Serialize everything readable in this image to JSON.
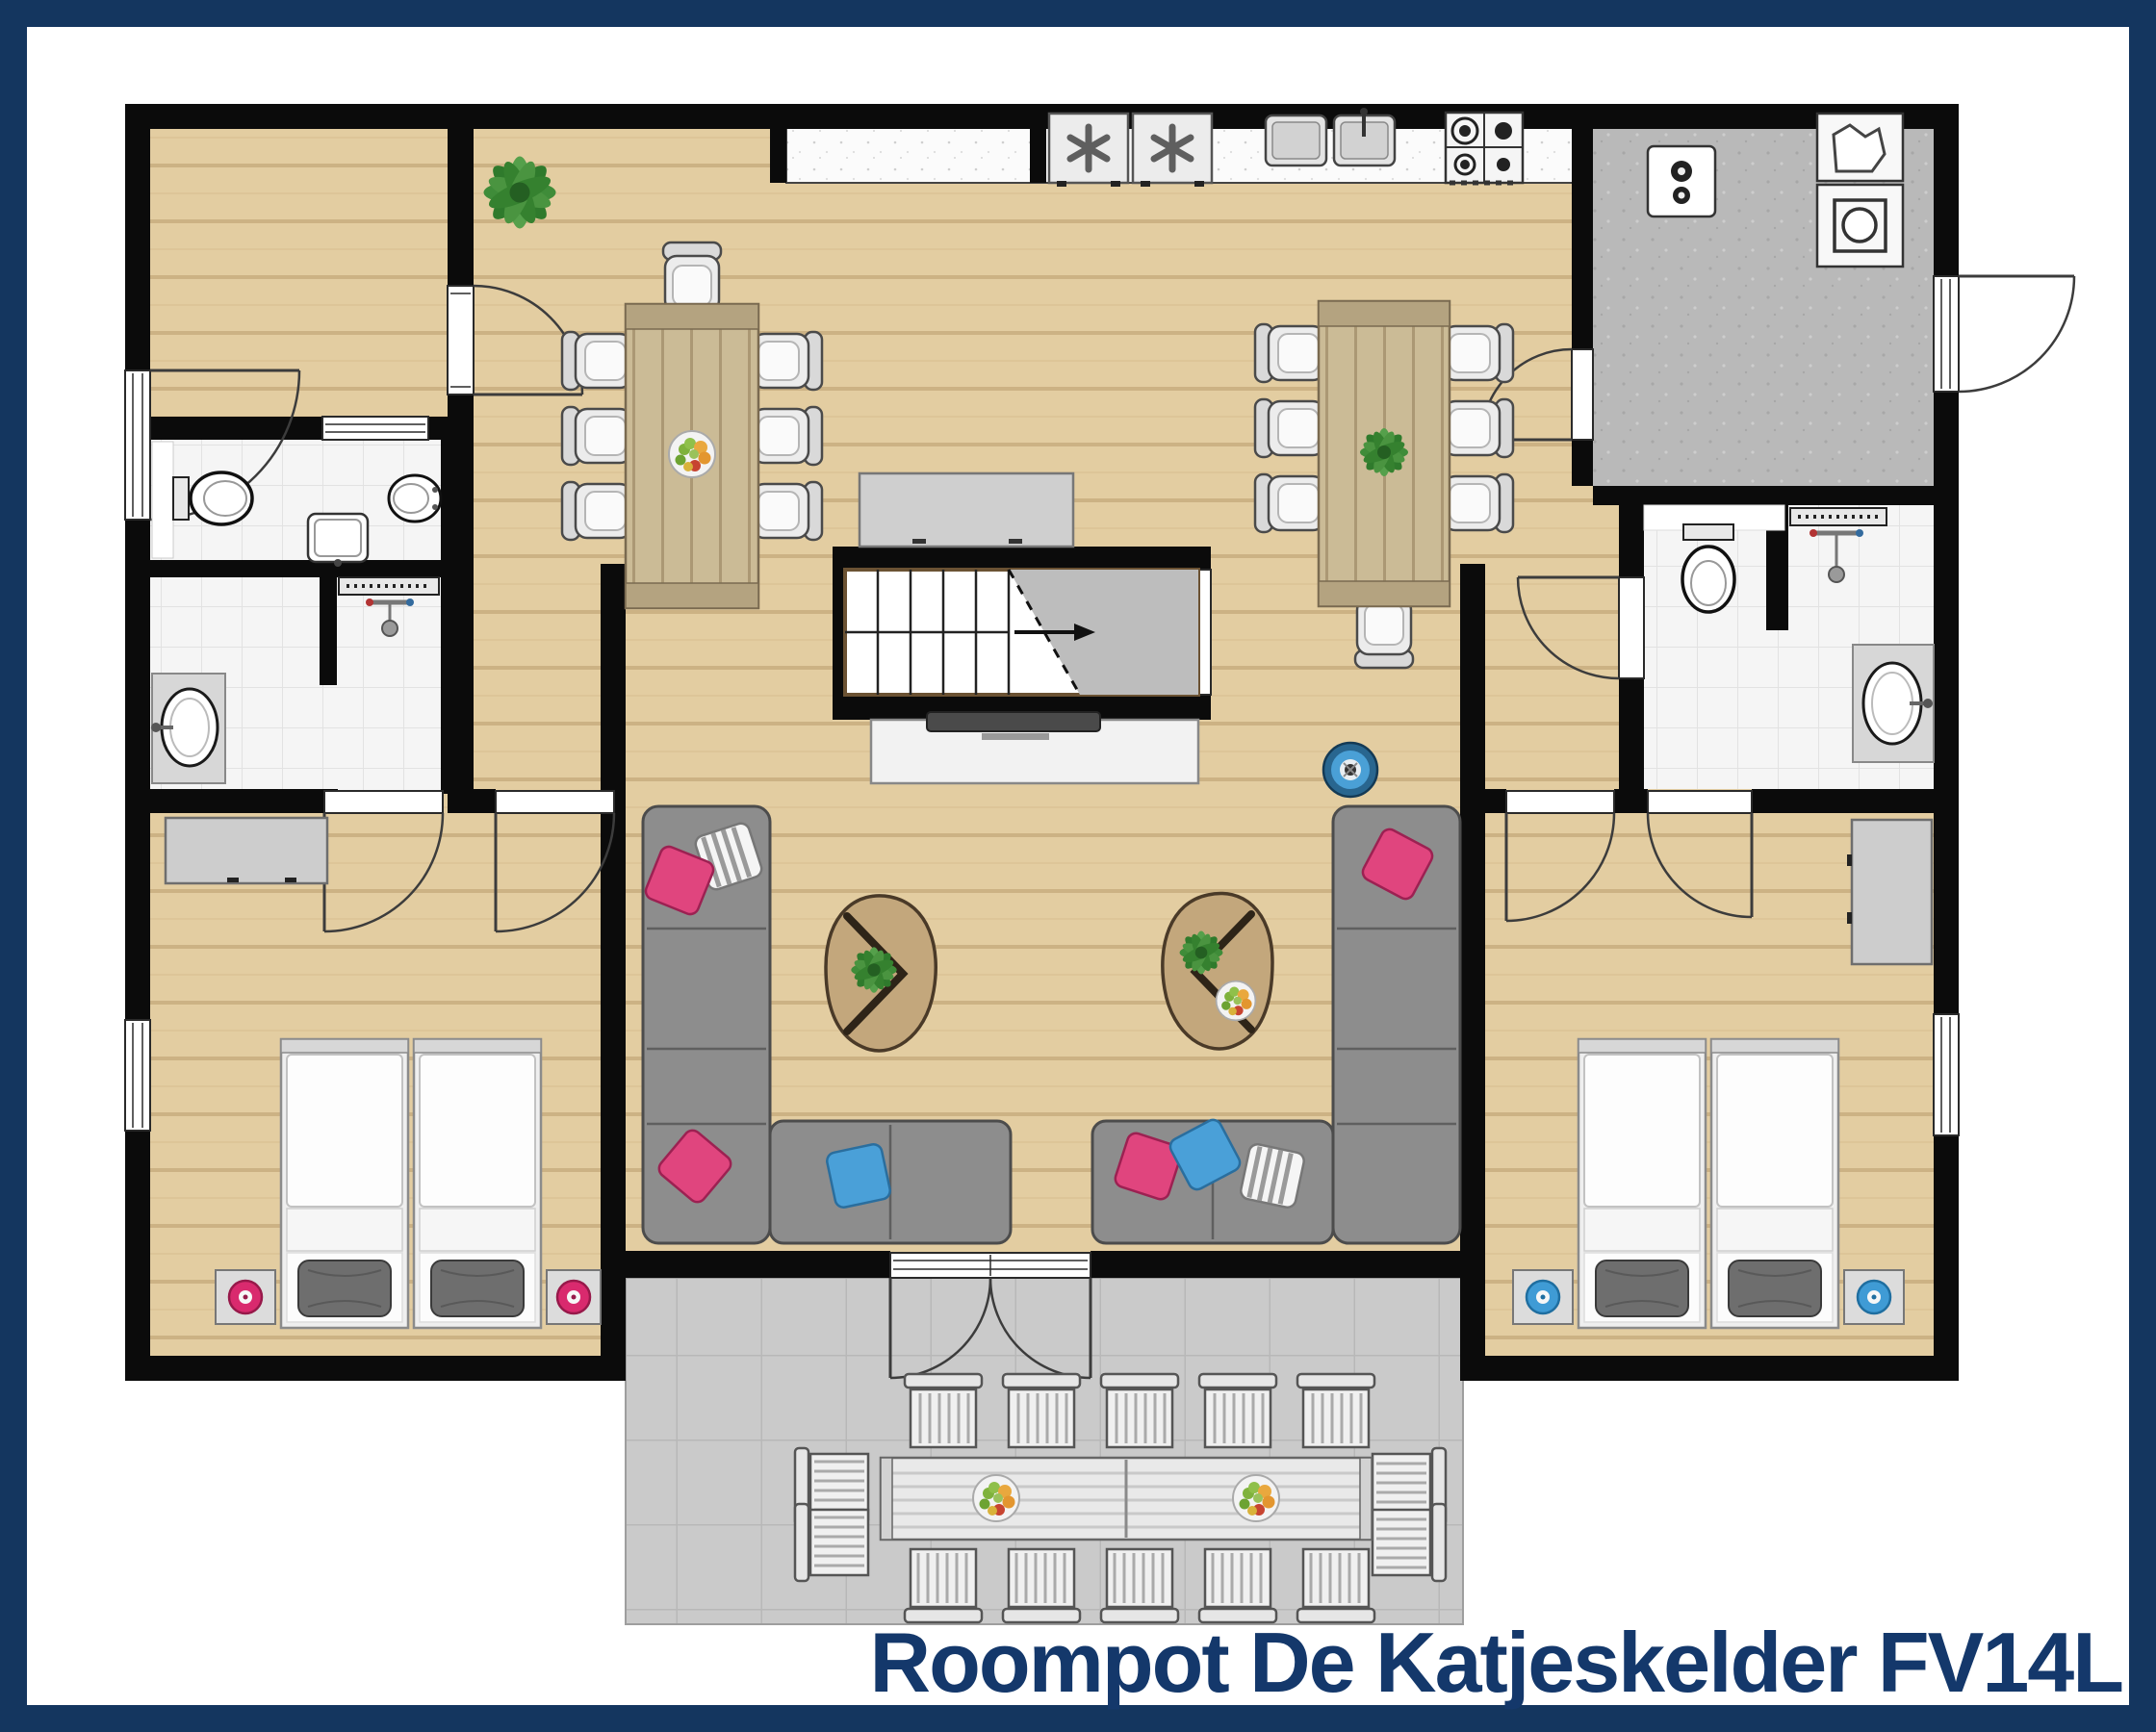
{
  "title": {
    "text": "Roompot De Katjeskelder FV14L"
  },
  "colors": {
    "frame": "#14365f",
    "title": "#14386b",
    "wall": "#0b0b0b",
    "wood_floor": "#e3cda1",
    "wood_plank_line": "#c4a97b",
    "table_wood": "#cbbb96",
    "tile_floor": "#f5f5f5",
    "concrete_floor": "#b9b9b9",
    "terrace_floor": "#cacaca",
    "counter_top": "#fbfbfb",
    "sofa_gray": "#8d8d8d",
    "accent_pink": "#d92a6e",
    "accent_blue": "#3f9bd5",
    "plant_green": "#3f8c39"
  },
  "rooms": [
    {
      "id": "entrance-hall",
      "label": "entrance hall",
      "furniture": [
        "entrance-door",
        "door-to-living-room",
        "plant"
      ]
    },
    {
      "id": "toilet-room-left",
      "label": "toilet room",
      "furniture": [
        "toilet",
        "bidet",
        "washbasin"
      ]
    },
    {
      "id": "shower-room-left",
      "label": "shower room",
      "furniture": [
        "shower-drain-channel",
        "shower-mixer",
        "washbasin-on-counter",
        "partition-wall"
      ]
    },
    {
      "id": "bedroom-left",
      "label": "bedroom (2 single beds)",
      "furniture": [
        "single-bed",
        "single-bed",
        "nightstand-with-pink-slippers",
        "nightstand-with-pink-slippers",
        "wardrobe",
        "window"
      ]
    },
    {
      "id": "living-dining",
      "label": "living / dining room",
      "furniture": [
        "dining-table-8-seats",
        "dining-table-7-seats",
        "corner-sofa-left",
        "corner-sofa-right",
        "coffee-table-with-plant",
        "coffee-table-with-plant-and-fruit-bowl",
        "tv-cabinet-with-tv",
        "sideboard",
        "staircase-up",
        "round-blue-stool",
        "plant",
        "french-doors-to-terrace"
      ]
    },
    {
      "id": "kitchen",
      "label": "kitchen",
      "furniture": [
        "worktop",
        "fridge-freezer",
        "fridge-freezer",
        "double-sink-with-faucet",
        "gas-hob-4-burners"
      ]
    },
    {
      "id": "utility-room",
      "label": "utility / laundry room",
      "furniture": [
        "wall-boiler",
        "utility-sink",
        "washing-machine",
        "exterior-door"
      ]
    },
    {
      "id": "bathroom-right",
      "label": "bathroom",
      "furniture": [
        "toilet",
        "shower-drain-channel",
        "shower-mixer",
        "washbasin-on-counter",
        "partition-wall"
      ]
    },
    {
      "id": "bedroom-right",
      "label": "bedroom (2 single beds)",
      "furniture": [
        "single-bed",
        "single-bed",
        "nightstand-with-blue-slippers",
        "nightstand-with-blue-slippers",
        "wardrobe",
        "window"
      ]
    },
    {
      "id": "terrace",
      "label": "terrace",
      "furniture": [
        "outdoor-dining-table",
        "fruit-bowl",
        "fruit-bowl",
        "outdoor-chair-x14"
      ]
    }
  ]
}
